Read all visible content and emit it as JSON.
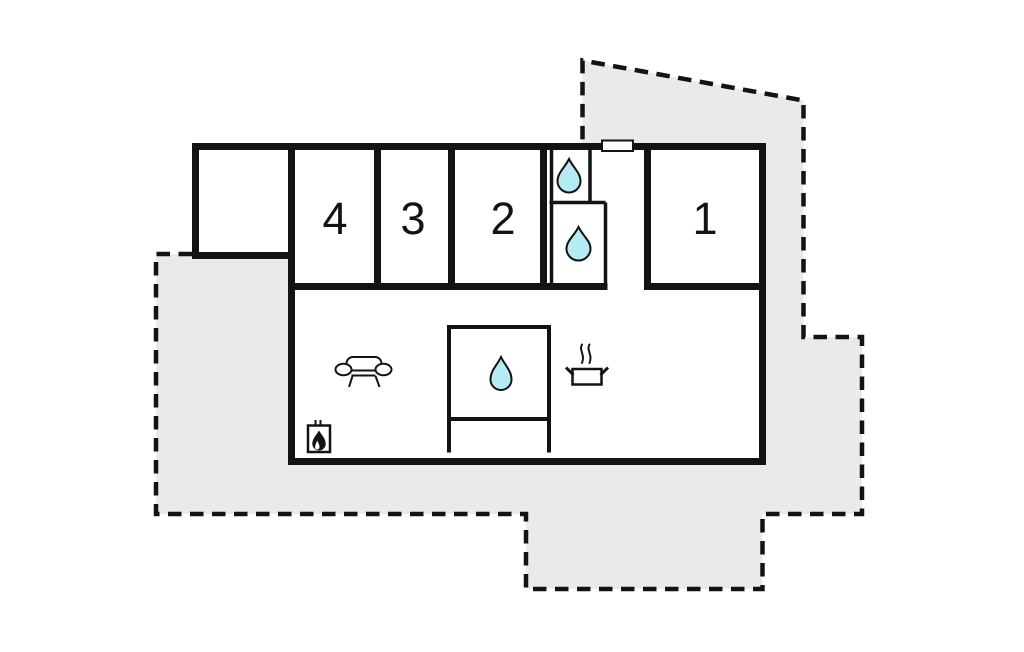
{
  "floor_plan": {
    "type": "vacation-home-floor-plan",
    "rooms": [
      {
        "number": "1"
      },
      {
        "number": "2"
      },
      {
        "number": "3"
      },
      {
        "number": "4"
      }
    ],
    "icons": [
      "water-drop-icon (bathroom, upper)",
      "water-drop-icon (bathroom, lower)",
      "water-drop-icon (shower room, living area)",
      "sofa-icon",
      "fireplace-icon",
      "cooking-pot-icon",
      "entrance-door"
    ],
    "colors": {
      "wall": "#131313",
      "plot_fill": "#e8ebea",
      "water_drop_fill": "#b5ebf4",
      "interior_fill": "#ffffff"
    }
  }
}
